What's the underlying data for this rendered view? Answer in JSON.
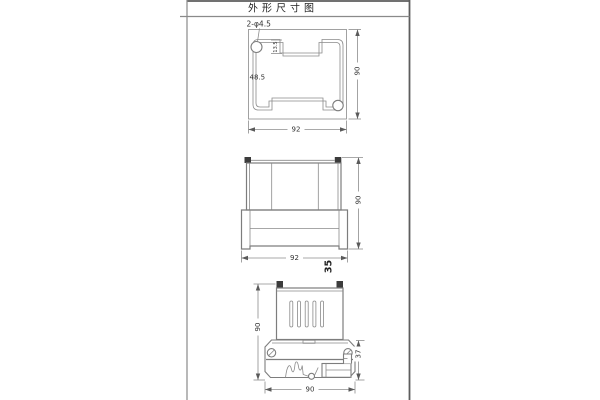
{
  "drawing": {
    "title": "外形尺寸图",
    "top_view": {
      "hole_label": "2-φ4.5",
      "notch_depth": "13.5",
      "inner_width": "48.5",
      "height": "90",
      "width": "92"
    },
    "front_view": {
      "height": "90",
      "width": "92",
      "depth": "35"
    },
    "side_view": {
      "height": "90",
      "rail_height": "37",
      "width": "90"
    },
    "colors": {
      "line": "#7d7d7d",
      "text": "#333333",
      "screw_square": "#3c3c3c",
      "background": "#ffffff"
    }
  }
}
